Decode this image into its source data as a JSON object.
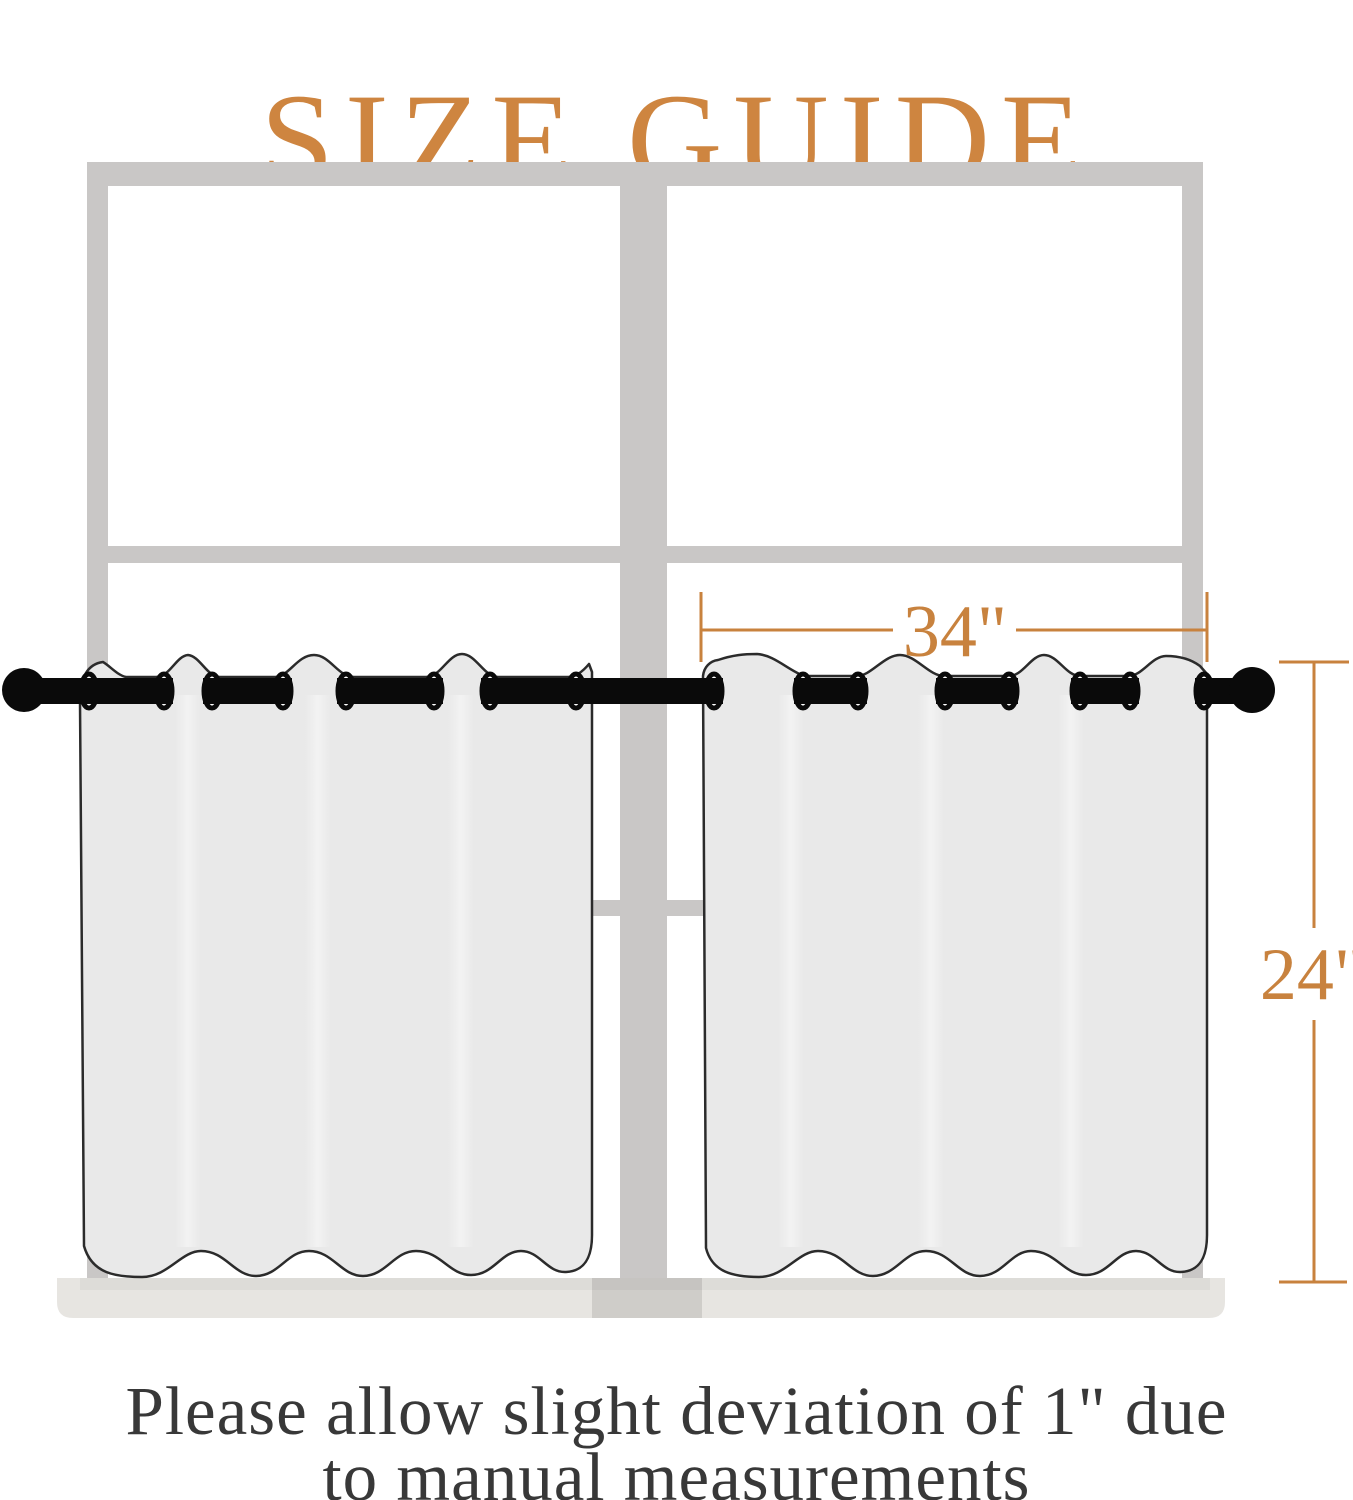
{
  "title": {
    "text": "SIZE GUIDE",
    "color": "#CE8540"
  },
  "diagram": {
    "accent_color": "#C8823E",
    "window_frame_color": "#C9C7C6",
    "sill_color": "#E7E5E1",
    "sill_shadow_color": "#CFCDC9",
    "curtain_fill_color": "#E9E9E9",
    "curtain_outline_color": "#2B2B2B",
    "rod_color": "#0A0A0A",
    "width_label": "34\"",
    "height_label": "24\""
  },
  "footer": {
    "line1": "Please allow slight deviation of 1\" due",
    "line2": "to manual measurements",
    "color": "#383838"
  }
}
